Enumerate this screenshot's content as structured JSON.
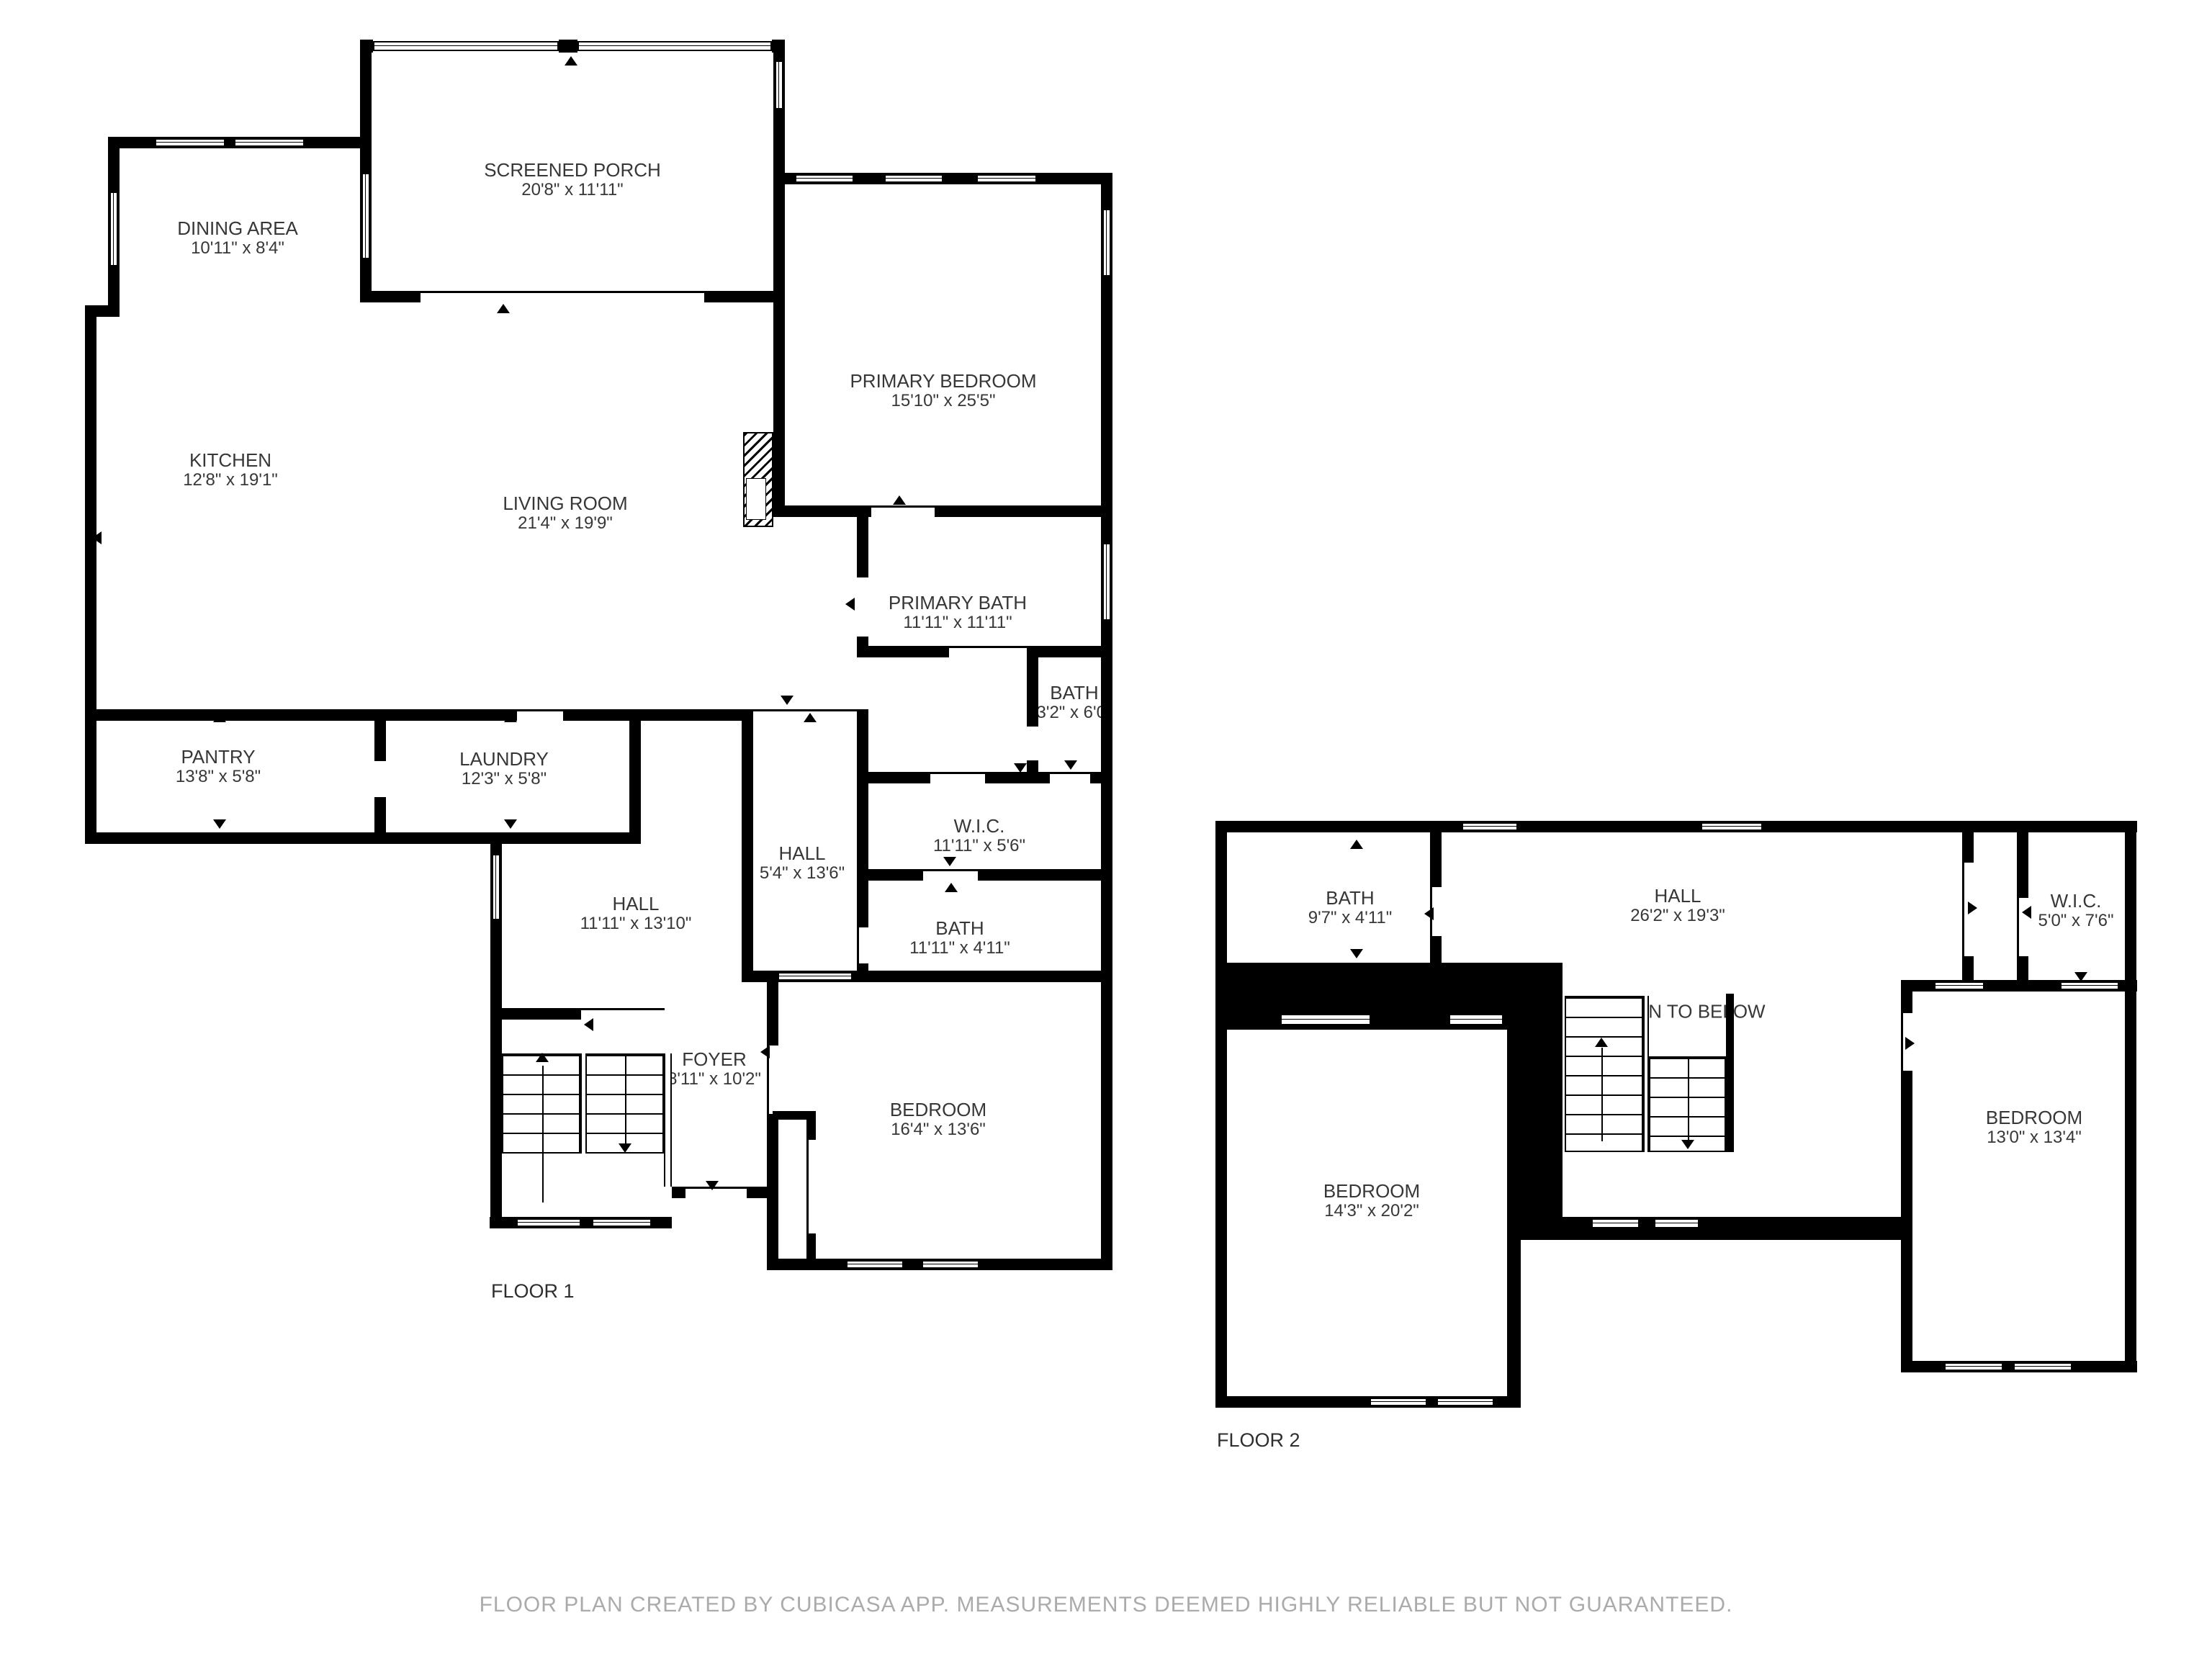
{
  "colors": {
    "wall": "#000000",
    "background": "#ffffff",
    "label": "#373737",
    "footer": "#ababab"
  },
  "floor1": {
    "label": "FLOOR 1",
    "rooms": [
      {
        "name": "SCREENED PORCH",
        "dims": "20'8\" x 11'11\""
      },
      {
        "name": "DINING AREA",
        "dims": "10'11\" x 8'4\""
      },
      {
        "name": "PRIMARY BEDROOM",
        "dims": "15'10\" x 25'5\""
      },
      {
        "name": "KITCHEN",
        "dims": "12'8\" x 19'1\""
      },
      {
        "name": "LIVING ROOM",
        "dims": "21'4\" x 19'9\""
      },
      {
        "name": "PRIMARY BATH",
        "dims": "11'11\" x 11'11\""
      },
      {
        "name": "BATH",
        "dims": "3'2\" x 6'0\""
      },
      {
        "name": "PANTRY",
        "dims": "13'8\" x 5'8\""
      },
      {
        "name": "LAUNDRY",
        "dims": "12'3\" x 5'8\""
      },
      {
        "name": "HALL",
        "dims": "5'4\" x 13'6\""
      },
      {
        "name": "W.I.C.",
        "dims": "11'11\" x 5'6\""
      },
      {
        "name": "BATH",
        "dims": "11'11\" x 4'11\""
      },
      {
        "name": "HALL",
        "dims": "11'11\" x 13'10\""
      },
      {
        "name": "FOYER",
        "dims": "8'11\" x 10'2\""
      },
      {
        "name": "BEDROOM",
        "dims": "16'4\" x 13'6\""
      }
    ]
  },
  "floor2": {
    "label": "FLOOR 2",
    "annotations": {
      "open_to_below": "OPEN TO BELOW"
    },
    "rooms": [
      {
        "name": "BATH",
        "dims": "9'7\" x 4'11\""
      },
      {
        "name": "HALL",
        "dims": "26'2\" x 19'3\""
      },
      {
        "name": "W.I.C.",
        "dims": "5'0\" x 7'6\""
      },
      {
        "name": "BEDROOM",
        "dims": "14'3\" x 20'2\""
      },
      {
        "name": "BEDROOM",
        "dims": "13'0\" x 13'4\""
      }
    ]
  },
  "footer": {
    "text": "FLOOR PLAN CREATED BY CUBICASA APP. MEASUREMENTS DEEMED HIGHLY RELIABLE BUT NOT GUARANTEED."
  }
}
